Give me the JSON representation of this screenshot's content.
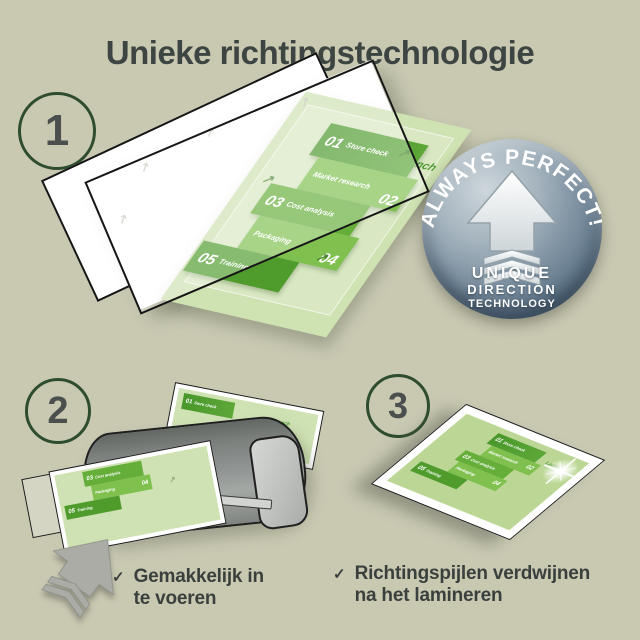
{
  "title": "Unieke richtingstechnologie",
  "steps": [
    {
      "number": "1"
    },
    {
      "number": "2"
    },
    {
      "number": "3"
    }
  ],
  "infographic": {
    "launch": "Launch",
    "items": [
      {
        "num": "01",
        "label": "Store check"
      },
      {
        "num": "02",
        "label": "Market research"
      },
      {
        "num": "03",
        "label": "Cost analysis"
      },
      {
        "num": "04",
        "label": "Packaging"
      },
      {
        "num": "05",
        "label": "Training"
      }
    ]
  },
  "badge": {
    "arc_text": "ALWAYS PERFECT!",
    "lines": [
      "UNIQUE",
      "DIRECTION",
      "TECHNOLOGY"
    ]
  },
  "checklist": [
    {
      "mark": "✓",
      "line1": "Gemakkelijk in",
      "line2": "te voeren"
    },
    {
      "mark": "✓",
      "line1": "Richtingspijlen verdwijnen",
      "line2": "na het lamineren"
    }
  ],
  "icons": {
    "direction_arrow": "↗"
  },
  "colors": {
    "background": "#c9c9b2",
    "title_text": "#3d4543",
    "circle_green": "#2e4c2e",
    "green_dark": "#4e9a2e",
    "green_mid": "#7fc04f",
    "green_deep": "#66ae3a",
    "sheet_green": "#cfe2b2",
    "badge_slate_light": "#cdd6db",
    "badge_slate_dark": "#46596b",
    "laminator_gray": "#8f9492",
    "arrow_gray": "#abaca6",
    "check_text": "#3a403d"
  }
}
